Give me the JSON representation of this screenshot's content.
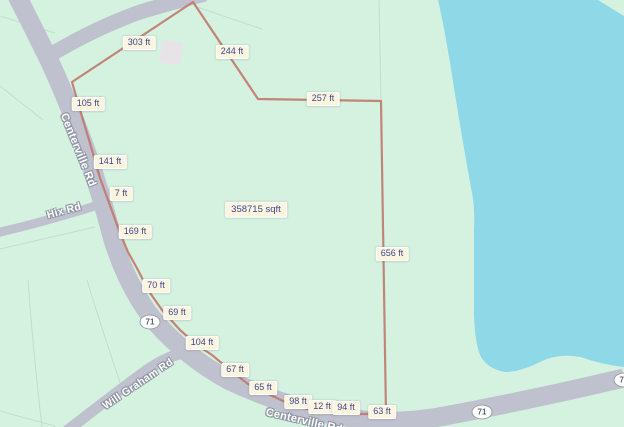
{
  "colors": {
    "land": "#d5f2e1",
    "water": "#8fd8e8",
    "road": "#bfc1ce",
    "boundary_line": "#c1786d",
    "measurement_pill_bg": "#fbf5df",
    "measurement_text": "#3a468f",
    "road_label_text": "#ffffff",
    "building": "#e8e3e6"
  },
  "roads": {
    "centerville_label": "Centerville Rd",
    "centerville_bottom_label": "Centerville Rd",
    "hix_label": "Hix Rd",
    "will_graham_label": "Will Graham Rd",
    "route_shield": "71"
  },
  "measurements": {
    "area": {
      "text": "358715 sqft",
      "x": 256,
      "y": 210
    },
    "segments": [
      {
        "text": "303 ft",
        "x": 139,
        "y": 43
      },
      {
        "text": "244 ft",
        "x": 232,
        "y": 52
      },
      {
        "text": "257 ft",
        "x": 323,
        "y": 99
      },
      {
        "text": "105 ft",
        "x": 88,
        "y": 104
      },
      {
        "text": "141 ft",
        "x": 110,
        "y": 162
      },
      {
        "text": "7 ft",
        "x": 121,
        "y": 194
      },
      {
        "text": "169 ft",
        "x": 135,
        "y": 232
      },
      {
        "text": "70 ft",
        "x": 156,
        "y": 286
      },
      {
        "text": "69 ft",
        "x": 177,
        "y": 313
      },
      {
        "text": "104 ft",
        "x": 202,
        "y": 343
      },
      {
        "text": "67 ft",
        "x": 235,
        "y": 370
      },
      {
        "text": "65 ft",
        "x": 263,
        "y": 388
      },
      {
        "text": "98 ft",
        "x": 298,
        "y": 402
      },
      {
        "text": "12 ft",
        "x": 322,
        "y": 407
      },
      {
        "text": "94 ft",
        "x": 346,
        "y": 408
      },
      {
        "text": "63 ft",
        "x": 382,
        "y": 412
      },
      {
        "text": "656 ft",
        "x": 392,
        "y": 254
      }
    ]
  }
}
